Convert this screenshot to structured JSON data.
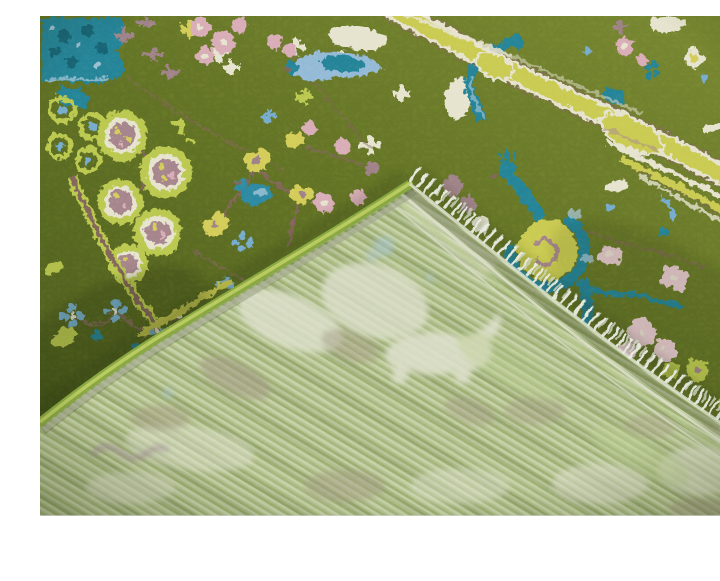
{
  "scene": {
    "type": "photograph",
    "description": "Overhead photo of a moss-green hand-knotted Oushak-style wool rug with its corner folded over, exposing the pale sage woven back side and a diagonal row of short ivory fringe tassels. The green pile face is decorated with chartreuse rosette flowers, pink and sky-blue blossoms, teal peacock and bird figures, mauve branch stems, and a wavy chartreuse border ribbon. A plain white margin runs along the bottom edge of the photo.",
    "subjects": [
      "green rug front pile",
      "chartreuse wavy border ribbon",
      "teal peacock motif with yellow body",
      "teal bird motifs",
      "chartreuse rosette chain",
      "pink blossom clusters",
      "folded corner showing woven back",
      "ivory fringe tassels",
      "bright green serged edge",
      "white photo margin"
    ]
  },
  "palette": {
    "front_light": "#71802e",
    "front_mid": "#5a6a22",
    "front_dark": "#44531a",
    "chartreuse": "#b9c84d",
    "band_yellow": "#c9ca50",
    "yellow": "#d3cc56",
    "teal": "#217e95",
    "teal_dark": "#135f72",
    "teal_mid": "#2a84a0",
    "sky_blue": "#6fa9cf",
    "powder_blue": "#a9cade",
    "blue_patch": "#8fb8d8",
    "pink": "#d9aab6",
    "pink_light": "#e6c6cd",
    "mauve": "#9b7b85",
    "mauve_center": "#a27f89",
    "stem_brown": "#7d6058",
    "dark_blob": "#63503f",
    "ivory": "#e7e4cf",
    "serge_green": "#82a33e",
    "serge_light": "#b5c95c",
    "back_base": "#aec08a",
    "back_stripe_light": "#c6d2a4",
    "back_stripe_dark": "#97aa6c",
    "back_ivory": "#dcdfca",
    "back_taupe": "#a09780",
    "back_mauve": "#9d8498",
    "back_blue": "#a4c4d6",
    "back_chartreuse": "#b9cc8c",
    "fringe_white": "#e9ede2",
    "fringe_shade": "#ccd6c2",
    "edge_stitch": "#dce2cf",
    "shadow": "#1f2608",
    "margin_white": "#ffffff",
    "hairline": "#d9d9d9"
  }
}
